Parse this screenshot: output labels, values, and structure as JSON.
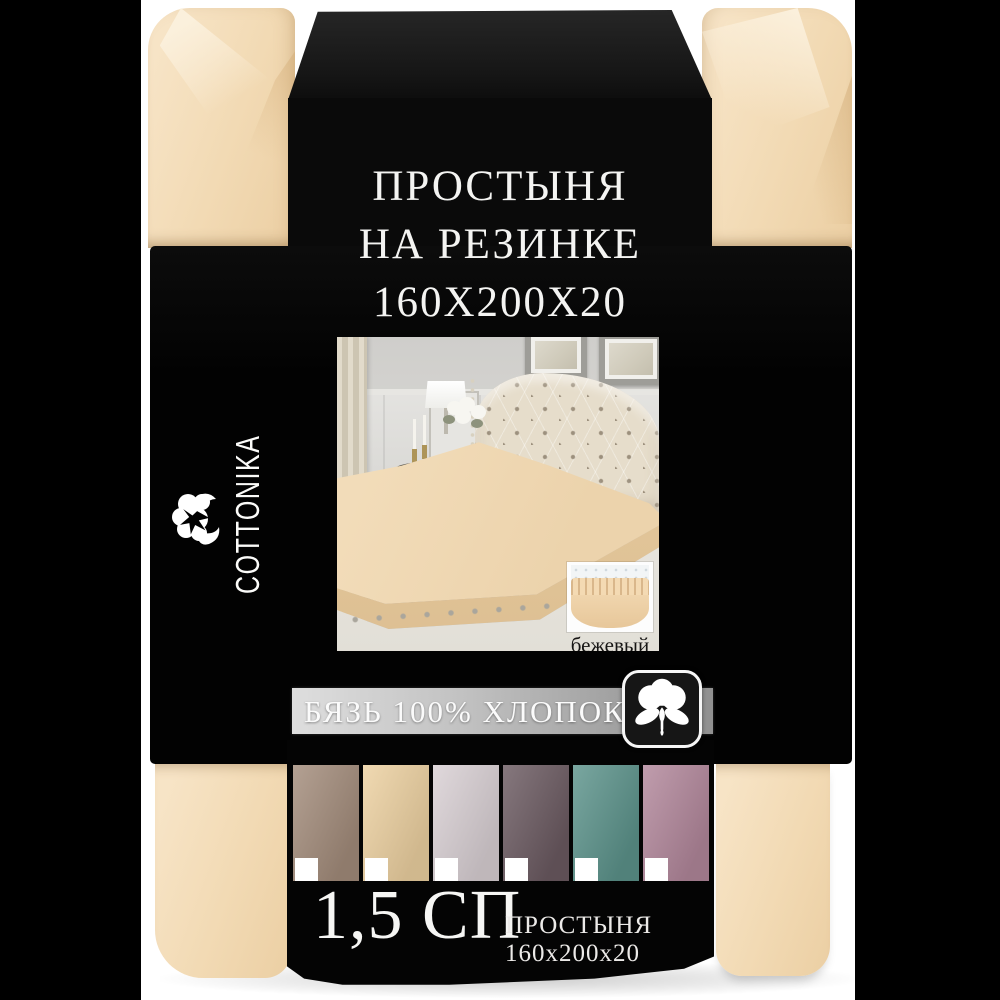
{
  "product": {
    "title_line1": "ПРОСТЫНЯ",
    "title_line2": "НА РЕЗИНКЕ",
    "title_line3": "160X200X20",
    "brand": "COTTONIKA",
    "material": "БЯЗЬ 100% ХЛОПОК",
    "size": "1,5 СП",
    "bottom_caption": "ПРОСТЫНЯ 160x200x20",
    "color_name": "бежевый"
  },
  "colors": {
    "background": "#ffffff",
    "side_bars": "#000000",
    "sleeve_black": "#050505",
    "fabric_beige": "#f3dcb8",
    "strip_silver_left": "#dedede",
    "strip_silver_right": "#919191",
    "text_white": "#f5f5f5"
  },
  "icons": {
    "brand_logo": "cotton-flower-icon",
    "material_badge": "cotton-boll-icon"
  },
  "swatches": [
    {
      "name": "taupe",
      "color": "#a38c7b"
    },
    {
      "name": "beige",
      "color": "#edd1a1"
    },
    {
      "name": "light-lilac-gray",
      "color": "#d9d0d4"
    },
    {
      "name": "dark-mauve-gray",
      "color": "#6b5a61"
    },
    {
      "name": "teal",
      "color": "#5c938b"
    },
    {
      "name": "dusty-rose",
      "color": "#b2879b"
    }
  ]
}
